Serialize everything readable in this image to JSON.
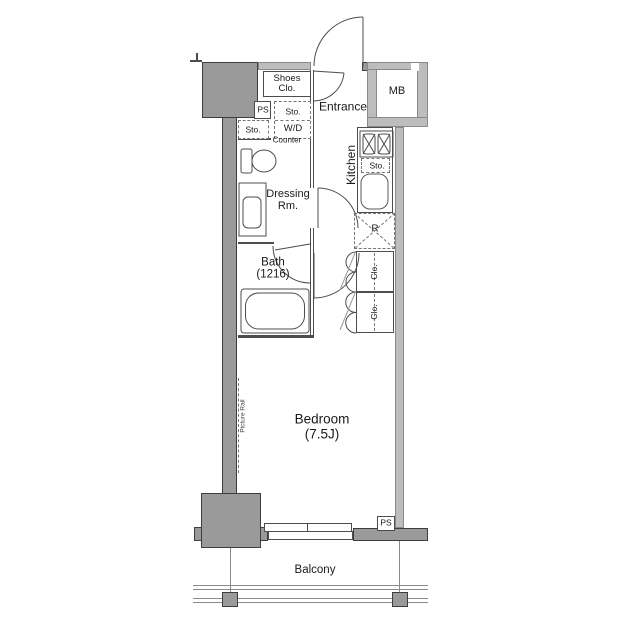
{
  "colors": {
    "background": "#ffffff",
    "wall_dark": "#9a9a9a",
    "wall_light": "#bdbdbd",
    "line": "#4d4d4d",
    "text": "#1a1a1a"
  },
  "labels": {
    "entrance": "Entrance",
    "shoes_closet_line1": "Shoes",
    "shoes_closet_line2": "Clo.",
    "meter_box": "MB",
    "pipe_space_top": "PS",
    "storage_top": "Sto.",
    "washer_dryer": "W/D",
    "storage_left": "Sto.",
    "counter": "Counter",
    "dressing_line1": "Dressing",
    "dressing_line2": "Rm.",
    "kitchen": "Kitchen",
    "storage_kitchen": "Sto.",
    "refrigerator": "R",
    "bath_line1": "Bath",
    "bath_line2": "(1216)",
    "closet_upper": "Clo.",
    "closet_lower": "Clo.",
    "bedroom_line1": "Bedroom",
    "bedroom_line2": "(7.5J)",
    "picture_rail": "Picture Rail",
    "pipe_space_bottom": "PS",
    "balcony": "Balcony"
  }
}
